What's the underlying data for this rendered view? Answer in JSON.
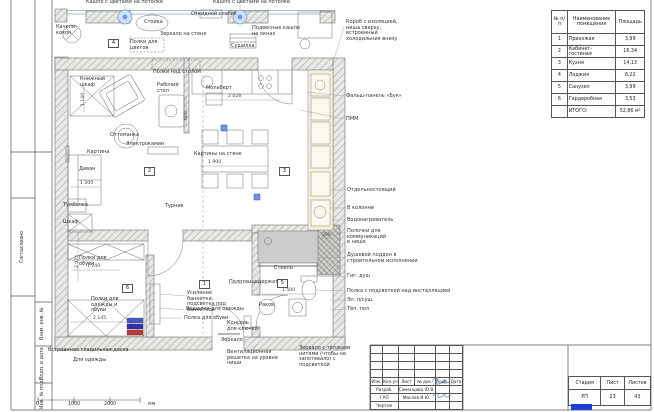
{
  "frame": {
    "side_stamp": {
      "agreed": "Согласовано",
      "replace_inv": "Взам. инв. №",
      "sign_date": "Подп. и дата",
      "inv_original": "Инв. № подл."
    },
    "scale_bar": {
      "t0": "0",
      "t1": "1000",
      "t2": "2000",
      "unit": "мм"
    }
  },
  "schedule": {
    "col_num": "№ п/п",
    "col_name": "Наименование помещения",
    "col_area": "Площадь",
    "rows": [
      {
        "num": "1",
        "name": "Прихожая",
        "area": "3,99"
      },
      {
        "num": "2",
        "name": "Кабинет-гостиная",
        "area": "16,34"
      },
      {
        "num": "3",
        "name": "Кухня",
        "area": "14,13"
      },
      {
        "num": "4",
        "name": "Лоджия",
        "area": "8,22"
      },
      {
        "num": "5",
        "name": "Санузел",
        "area": "3,99"
      },
      {
        "num": "6",
        "name": "Гардеробная",
        "area": "3,53"
      }
    ],
    "total_label": "ИТОГО:",
    "total_value": "52,86 м²"
  },
  "titleblock": {
    "cols": [
      "Изм.",
      "Кол.уч",
      "Лист",
      "№ док.",
      "Подп.",
      "Дата"
    ],
    "rows": [
      {
        "role": "Разраб.",
        "name": "Семенцова Ю.В."
      },
      {
        "role": "ГАП",
        "name": "Маслов И.Ю."
      },
      {
        "role": "Чертил",
        "name": ""
      }
    ],
    "stage_label": "Стадия",
    "sheet_label": "Лист",
    "sheets_label": "Листов",
    "stage": "РП",
    "sheet": "23",
    "sheets": "43"
  },
  "plan": {
    "room_tags": {
      "hall": "1",
      "study": "2",
      "kitchen": "3",
      "loggia": "4",
      "bath": "5",
      "wardrobe": "6"
    },
    "dims": {
      "d1": "1 140",
      "d2": "600",
      "d3": "2 028",
      "d4": "1 900",
      "d5": "1 200",
      "d6": "2 075",
      "d7": "1 740",
      "d8": "2 145",
      "d9": "1 500",
      "d10": "200"
    },
    "labels": {
      "swing": "Качели-кокон",
      "stand": "Стойка",
      "flower_shelves": "Полки для цветов",
      "wall_mirror": "Зеркало на стене",
      "fold_table": "Откидной столик",
      "dryer": "Сушилка",
      "shelves_above_desk": "Полки над столом",
      "bookcase": "Книжный шкаф",
      "desk": "Рабочий стол",
      "easel": "Мольберт",
      "ottoman": "Оттоманка",
      "fireplace": "Электрокамин",
      "painting": "Картина",
      "sofa": "Диван",
      "nightstand": "Тумбочка",
      "closet": "Шкаф",
      "pullup": "Турник",
      "paintings_wall": "Картины на стене",
      "glass": "Стекло",
      "sink": "Раков.",
      "shoe_shelves": "Полки для обуви",
      "clothes_shelves": "Полки для одежды и обуви"
    }
  },
  "annotations": {
    "top_plants_left": "Кашпо с цветами на потолке",
    "top_plants_right": "Кашпо с цветами на потолке",
    "window_plants": "Подвесные кашпо на окнах",
    "fridge_box": "Короб с изоляцией, ниша сверху, встроенный холодильник внизу",
    "panel": "Фальш-панель «Бук»",
    "pmm": "ПММ",
    "freestanding": "Отдельностоящий",
    "in_column": "В колонне",
    "water_heater": "Водонагреватель",
    "niche_shelves": "Полочки для коммуникаций в нише",
    "shower_tray": "Душевой поддон в строительном исполнении",
    "hyg_shower": "Гиг. душ",
    "shelf_light": "Полка с подсветкой над инсталляцией",
    "towel_dryer": "Эл. п/суш.",
    "warm_floor": "Тёп. пол",
    "towel_holder": "Полотенцедержатель",
    "bench_note": "Усиление банкетки, подсветка под банкеткой",
    "hanger": "Вешалка для одежды",
    "shoe_shelf": "Полка для обуви",
    "keys_console": "Консоль для ключей",
    "mirror": "Зеркало",
    "vent_grille": "Вентиляционная решетка на уровне ниши",
    "warm_mirror": "Зеркало с тёплыми нитями (чтобы не запотевало) с подсветкой",
    "ironing_board": "Встроенная гладильная доска",
    "for_clothes": "Для одежды"
  },
  "colors": {
    "bar_blue": "#3f57c8",
    "bar_navy": "#2e2fa9",
    "bar_red": "#c23a31",
    "logo_blue": "#1f3fd4",
    "lamp_blue": "#cfe0f7",
    "signature_blue": "#3f6fd0"
  }
}
